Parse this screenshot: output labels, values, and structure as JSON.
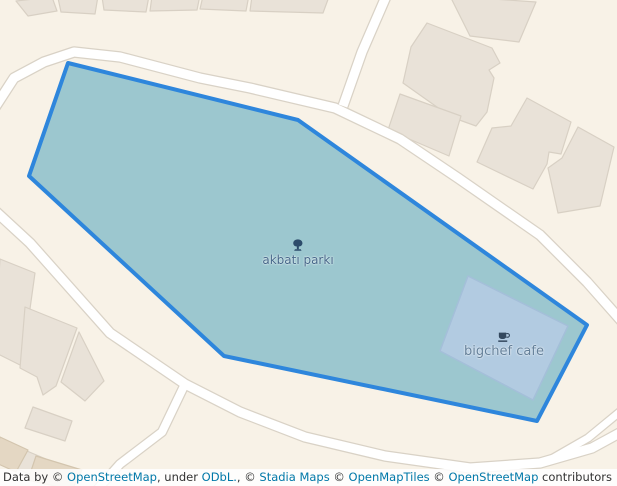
{
  "colors": {
    "background": "#f8f2e7",
    "road_fill": "#ffffff",
    "road_casing": "#d9d2c6",
    "building_fill": "#e9e2d8",
    "building_stroke": "#d8d0c4",
    "building_dark_fill": "#e4d7c3",
    "building_dark_stroke": "#d3c5ae",
    "park_fill": "#9cc7cf",
    "park_stroke": "#2e86dc",
    "cafe_fill": "#b2cbe1",
    "cafe_stroke": "#a4bfd9",
    "park_label": "#46688a",
    "park_icon": "#2d4c6b",
    "cafe_label": "#64809a",
    "cafe_icon": "#33485e",
    "attribution_bg": "rgba(255,255,255,0.85)",
    "attribution_text": "#333333",
    "attribution_link": "#0078a8"
  },
  "map": {
    "park": {
      "label": "akbatı parkı",
      "polygon": [
        [
          68,
          63
        ],
        [
          298,
          120
        ],
        [
          587,
          325
        ],
        [
          537,
          421
        ],
        [
          224,
          356
        ],
        [
          29,
          176
        ]
      ],
      "label_x": 298,
      "label_y": 239
    },
    "cafe": {
      "label": "bigchef cafe",
      "polygon": [
        [
          468,
          276
        ],
        [
          568,
          326
        ],
        [
          533,
          400
        ],
        [
          440,
          351
        ]
      ],
      "label_x": 504,
      "label_y": 331
    },
    "roads": [
      {
        "name": "ring-road-north",
        "width": 9,
        "points": [
          [
            -8,
            112
          ],
          [
            14,
            78
          ],
          [
            44,
            62
          ],
          [
            74,
            52
          ],
          [
            120,
            57
          ],
          [
            200,
            78
          ],
          [
            250,
            88
          ],
          [
            335,
            108
          ],
          [
            400,
            139
          ],
          [
            458,
            178
          ],
          [
            540,
            235
          ],
          [
            587,
            282
          ],
          [
            625,
            325
          ]
        ]
      },
      {
        "name": "north-branch-road",
        "width": 9,
        "points": [
          [
            343,
            106
          ],
          [
            362,
            52
          ],
          [
            388,
            -8
          ]
        ]
      },
      {
        "name": "southwest-road",
        "width": 9,
        "points": [
          [
            -8,
            208
          ],
          [
            30,
            243
          ],
          [
            110,
            333
          ],
          [
            185,
            384
          ],
          [
            240,
            412
          ],
          [
            305,
            437
          ],
          [
            385,
            456
          ],
          [
            470,
            468
          ],
          [
            540,
            463
          ],
          [
            592,
            448
          ],
          [
            625,
            430
          ]
        ]
      },
      {
        "name": "south-branch-road",
        "width": 8,
        "points": [
          [
            185,
            384
          ],
          [
            162,
            432
          ],
          [
            120,
            464
          ],
          [
            95,
            492
          ]
        ]
      },
      {
        "name": "southeast-branch-road",
        "width": 7,
        "points": [
          [
            622,
            410
          ],
          [
            588,
            438
          ],
          [
            548,
            461
          ]
        ]
      }
    ],
    "buildings": [
      {
        "points": [
          [
            16,
            1
          ],
          [
            52,
            -3
          ],
          [
            57,
            11
          ],
          [
            28,
            16
          ]
        ],
        "tone": "light"
      },
      {
        "points": [
          [
            58,
            -2
          ],
          [
            98,
            -4
          ],
          [
            95,
            14
          ],
          [
            61,
            12
          ]
        ],
        "tone": "light"
      },
      {
        "points": [
          [
            102,
            -3
          ],
          [
            149,
            -4
          ],
          [
            146,
            12
          ],
          [
            104,
            10
          ]
        ],
        "tone": "light"
      },
      {
        "points": [
          [
            152,
            -4
          ],
          [
            200,
            -5
          ],
          [
            197,
            10
          ],
          [
            150,
            11
          ]
        ],
        "tone": "light"
      },
      {
        "points": [
          [
            203,
            -4
          ],
          [
            249,
            -5
          ],
          [
            246,
            11
          ],
          [
            200,
            9
          ]
        ],
        "tone": "light"
      },
      {
        "points": [
          [
            252,
            -4
          ],
          [
            330,
            -6
          ],
          [
            323,
            13
          ],
          [
            250,
            11
          ]
        ],
        "tone": "light"
      },
      {
        "points": [
          [
            450,
            -4
          ],
          [
            536,
            2
          ],
          [
            519,
            42
          ],
          [
            470,
            36
          ]
        ],
        "tone": "light"
      },
      {
        "points": [
          [
            427,
            23
          ],
          [
            492,
            48
          ],
          [
            500,
            63
          ],
          [
            489,
            70
          ],
          [
            494,
            78
          ],
          [
            487,
            112
          ],
          [
            476,
            126
          ],
          [
            451,
            117
          ],
          [
            403,
            83
          ],
          [
            411,
            47
          ]
        ],
        "tone": "light"
      },
      {
        "points": [
          [
            400,
            94
          ],
          [
            461,
            116
          ],
          [
            449,
            156
          ],
          [
            388,
            130
          ]
        ],
        "tone": "light"
      },
      {
        "points": [
          [
            477,
            162
          ],
          [
            492,
            128
          ],
          [
            511,
            126
          ],
          [
            527,
            98
          ],
          [
            571,
            122
          ],
          [
            561,
            154
          ],
          [
            549,
            152
          ],
          [
            547,
            164
          ],
          [
            533,
            189
          ]
        ],
        "tone": "light"
      },
      {
        "points": [
          [
            578,
            127
          ],
          [
            614,
            147
          ],
          [
            600,
            206
          ],
          [
            558,
            213
          ],
          [
            548,
            168
          ],
          [
            562,
            158
          ]
        ],
        "tone": "light"
      },
      {
        "points": [
          [
            0,
            259
          ],
          [
            35,
            273
          ],
          [
            22,
            366
          ],
          [
            -6,
            352
          ]
        ],
        "tone": "light"
      },
      {
        "points": [
          [
            25,
            307
          ],
          [
            77,
            328
          ],
          [
            56,
            386
          ],
          [
            43,
            395
          ],
          [
            37,
            377
          ],
          [
            20,
            368
          ]
        ],
        "tone": "light"
      },
      {
        "points": [
          [
            79,
            332
          ],
          [
            104,
            381
          ],
          [
            85,
            401
          ],
          [
            61,
            382
          ]
        ],
        "tone": "light"
      },
      {
        "points": [
          [
            33,
            407
          ],
          [
            72,
            421
          ],
          [
            65,
            441
          ],
          [
            25,
            428
          ]
        ],
        "tone": "light"
      },
      {
        "points": [
          [
            8,
            443
          ],
          [
            53,
            462
          ],
          [
            47,
            481
          ],
          [
            2,
            463
          ]
        ],
        "tone": "light"
      },
      {
        "points": [
          [
            0,
            437
          ],
          [
            28,
            450
          ],
          [
            16,
            472
          ],
          [
            -6,
            462
          ]
        ],
        "tone": "dark"
      },
      {
        "points": [
          [
            36,
            456
          ],
          [
            82,
            470
          ],
          [
            72,
            490
          ],
          [
            28,
            480
          ]
        ],
        "tone": "dark"
      }
    ]
  },
  "attribution": {
    "segments": [
      {
        "text": "Leaflet",
        "link": true
      },
      {
        "text": " | Data by © ",
        "link": false
      },
      {
        "text": "OpenStreetMap",
        "link": true
      },
      {
        "text": ", under ",
        "link": false
      },
      {
        "text": "ODbL.",
        "link": true
      },
      {
        "text": ", © ",
        "link": false
      },
      {
        "text": "Stadia Maps",
        "link": true
      },
      {
        "text": " © ",
        "link": false
      },
      {
        "text": "OpenMapTiles",
        "link": true
      },
      {
        "text": " © ",
        "link": false
      },
      {
        "text": "OpenStreetMap",
        "link": true
      },
      {
        "text": " contributors",
        "link": false
      }
    ]
  }
}
